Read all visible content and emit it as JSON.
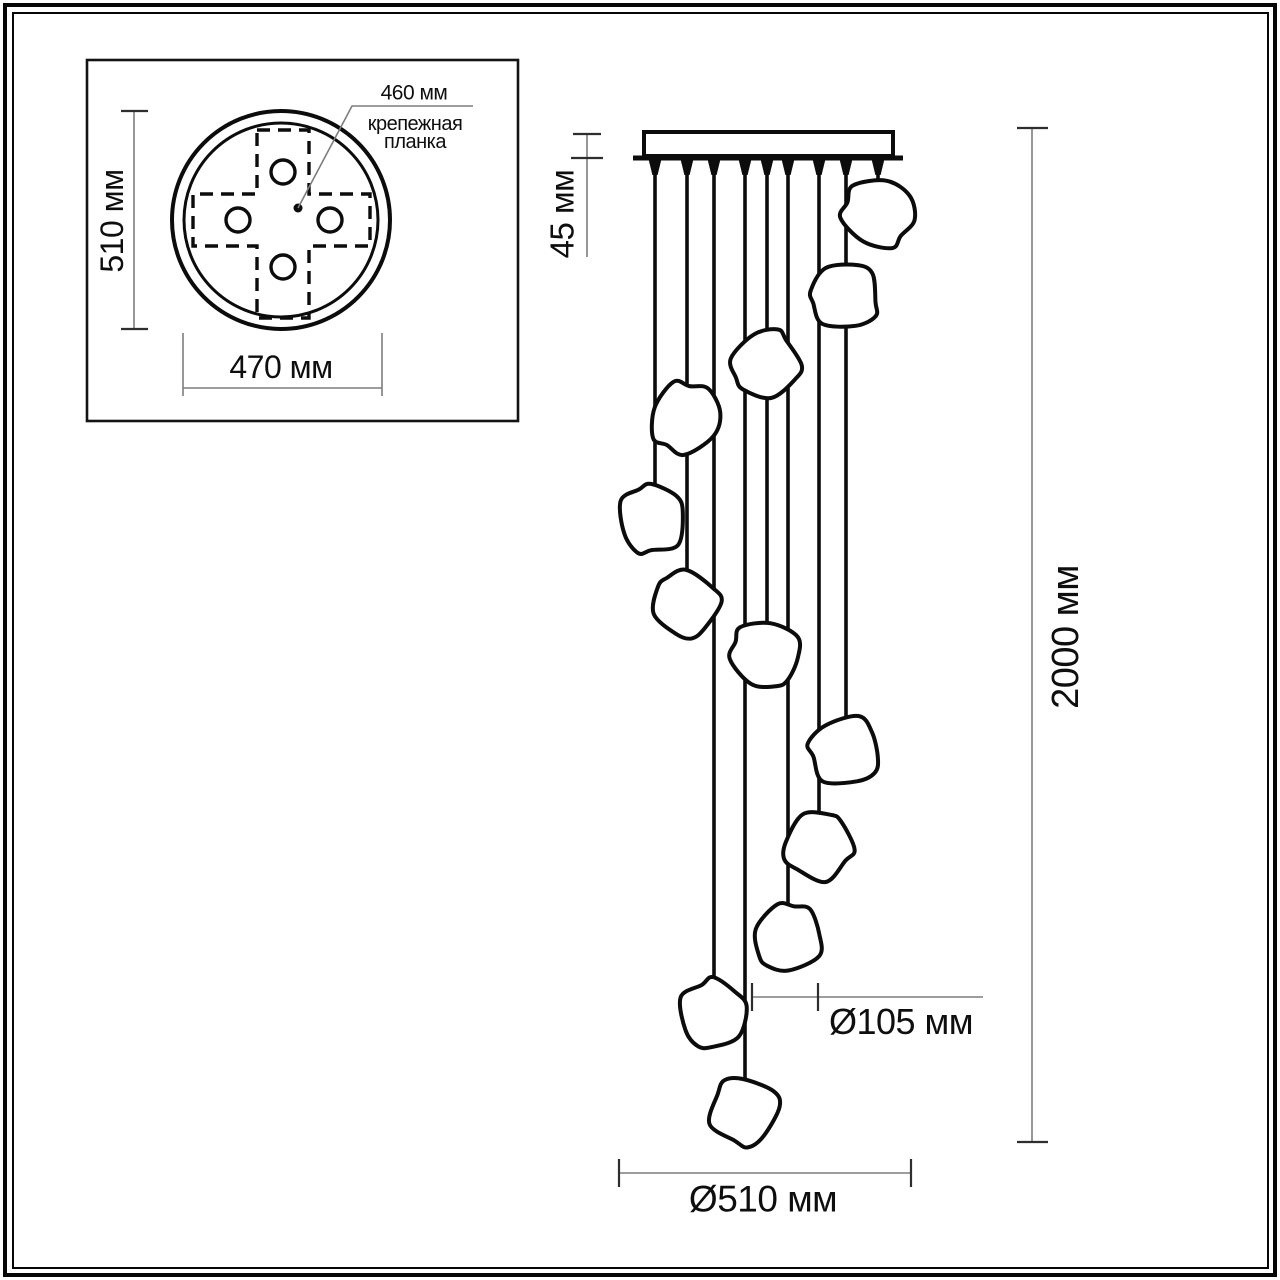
{
  "labels": {
    "mount_length": "460 мм",
    "mount_plate_line1": "крепежная",
    "mount_plate_line2": "планка",
    "canopy_height": "510 мм",
    "canopy_width": "470 мм",
    "plate_thickness": "45 мм",
    "total_height": "2000 мм",
    "shade_diameter": "Ø105 мм",
    "fixture_diameter": "Ø510 мм"
  },
  "dimensions_mm": {
    "mounting_bar_length": 460,
    "canopy_depth": 510,
    "canopy_width": 470,
    "ceiling_plate_thickness": 45,
    "total_suspension_height": 2000,
    "shade_diameter": 105,
    "fixture_footprint_diameter": 510,
    "shade_count": 12
  },
  "colors": {
    "background": "#ffffff",
    "drawing_line": "#0c0c0c",
    "dimension_line": "#7d7d7d",
    "tick_line": "#2e2e2e",
    "text": "#0e0e0e"
  },
  "diagram": {
    "presets": {
      "line4": {
        "stroke": "#0c0c0c",
        "stroke-width": "4",
        "fill": "none"
      },
      "line3": {
        "stroke": "#0c0c0c",
        "stroke-width": "3",
        "fill": "none"
      },
      "line5": {
        "stroke": "#0c0c0c",
        "stroke-width": "5",
        "fill": "none"
      },
      "lineThin": {
        "stroke": "#0c0c0c",
        "stroke-width": "3.6",
        "fill": "none"
      },
      "boxline": {
        "stroke": "#141414",
        "stroke-width": "2.6",
        "fill": "none"
      },
      "dash": {
        "stroke": "#0c0c0c",
        "stroke-width": "3.4",
        "fill": "none",
        "stroke-dasharray": "13 8"
      },
      "hole": {
        "stroke": "#0c0c0c",
        "stroke-width": "3.4",
        "fill": "#ffffff"
      },
      "solid": {
        "fill": "#0c0c0c",
        "stroke": "none"
      },
      "dim": {
        "stroke": "#7d7d7d",
        "stroke-width": "1.6",
        "fill": "none"
      },
      "tick": {
        "stroke": "#2e2e2e",
        "stroke-width": "2.2",
        "fill": "none"
      },
      "white4": {
        "fill": "#ffffff",
        "stroke": "#0c0c0c",
        "stroke-width": "4"
      }
    },
    "shapes": [
      {
        "type": "rect",
        "name": "top-view-inset-border",
        "preset": "boxline",
        "attrs": {
          "x": 87,
          "y": 60,
          "width": 431,
          "height": 361
        }
      },
      {
        "type": "circle",
        "name": "canopy-outer-circle",
        "preset": "line4",
        "attrs": {
          "cx": 281,
          "cy": 220,
          "r": 109
        }
      },
      {
        "type": "circle",
        "name": "canopy-inner-circle",
        "preset": "line3",
        "attrs": {
          "cx": 281,
          "cy": 220,
          "r": 97
        }
      },
      {
        "type": "path",
        "name": "mounting-bar-cross-dashed",
        "preset": "dash",
        "attrs": {
          "d": "M257,130 L309,130 L309,194 L370,194 L370,246 L309,246 L309,318 L257,318 L257,246 L193,246 L193,194 L257,194 Z"
        }
      },
      {
        "type": "circle",
        "name": "mount-hole-top",
        "preset": "hole",
        "attrs": {
          "cx": 283,
          "cy": 172,
          "r": 12
        }
      },
      {
        "type": "circle",
        "name": "mount-hole-left",
        "preset": "hole",
        "attrs": {
          "cx": 238,
          "cy": 220,
          "r": 12
        }
      },
      {
        "type": "circle",
        "name": "mount-hole-right",
        "preset": "hole",
        "attrs": {
          "cx": 330,
          "cy": 220,
          "r": 12
        }
      },
      {
        "type": "circle",
        "name": "mount-hole-bottom",
        "preset": "hole",
        "attrs": {
          "cx": 283,
          "cy": 267,
          "r": 12
        }
      },
      {
        "type": "circle",
        "name": "center-point-dot",
        "preset": "solid",
        "attrs": {
          "cx": 298,
          "cy": 208,
          "r": 4.5
        }
      },
      {
        "type": "polyline",
        "name": "leader-line-460mm",
        "preset": "dim",
        "attrs": {
          "points": "298,208 352,106 473,106"
        }
      },
      {
        "type": "line",
        "name": "dim-line-510mm-top-view",
        "preset": "dim",
        "attrs": {
          "x1": 134,
          "y1": 111,
          "x2": 134,
          "y2": 329
        }
      },
      {
        "type": "line",
        "name": "dim-tick",
        "preset": "tick",
        "attrs": {
          "x1": 121,
          "y1": 111,
          "x2": 148,
          "y2": 111
        }
      },
      {
        "type": "line",
        "name": "dim-tick",
        "preset": "tick",
        "attrs": {
          "x1": 121,
          "y1": 329,
          "x2": 148,
          "y2": 329
        }
      },
      {
        "type": "line",
        "name": "dim-ext-470-left",
        "preset": "dim",
        "attrs": {
          "x1": 183,
          "y1": 333,
          "x2": 183,
          "y2": 396
        }
      },
      {
        "type": "line",
        "name": "dim-ext-470-right",
        "preset": "dim",
        "attrs": {
          "x1": 382,
          "y1": 333,
          "x2": 382,
          "y2": 396
        }
      },
      {
        "type": "line",
        "name": "dim-line-470mm",
        "preset": "dim",
        "attrs": {
          "x1": 183,
          "y1": 388,
          "x2": 382,
          "y2": 388
        }
      },
      {
        "type": "line",
        "name": "dim-line-45mm",
        "preset": "dim",
        "attrs": {
          "x1": 587,
          "y1": 134,
          "x2": 587,
          "y2": 257
        }
      },
      {
        "type": "line",
        "name": "dim-tick",
        "preset": "tick",
        "attrs": {
          "x1": 573,
          "y1": 134,
          "x2": 601,
          "y2": 134
        }
      },
      {
        "type": "line",
        "name": "dim-tick",
        "preset": "tick",
        "attrs": {
          "x1": 571,
          "y1": 158,
          "x2": 603,
          "y2": 158
        }
      },
      {
        "type": "line",
        "name": "dim-line-2000mm",
        "preset": "dim",
        "attrs": {
          "x1": 1032,
          "y1": 128,
          "x2": 1032,
          "y2": 1142
        }
      },
      {
        "type": "line",
        "name": "dim-tick",
        "preset": "tick",
        "attrs": {
          "x1": 1017,
          "y1": 128,
          "x2": 1048,
          "y2": 128
        }
      },
      {
        "type": "line",
        "name": "dim-tick",
        "preset": "tick",
        "attrs": {
          "x1": 1017,
          "y1": 1142,
          "x2": 1048,
          "y2": 1142
        }
      },
      {
        "type": "line",
        "name": "dim-line-105mm",
        "preset": "dim",
        "attrs": {
          "x1": 752,
          "y1": 997,
          "x2": 983,
          "y2": 997
        }
      },
      {
        "type": "line",
        "name": "dim-tick",
        "preset": "tick",
        "attrs": {
          "x1": 752,
          "y1": 983,
          "x2": 752,
          "y2": 1011
        }
      },
      {
        "type": "line",
        "name": "dim-tick",
        "preset": "tick",
        "attrs": {
          "x1": 818,
          "y1": 983,
          "x2": 818,
          "y2": 1011
        }
      },
      {
        "type": "line",
        "name": "dim-line-510mm-bottom",
        "preset": "dim",
        "attrs": {
          "x1": 619,
          "y1": 1173,
          "x2": 911,
          "y2": 1173
        }
      },
      {
        "type": "line",
        "name": "dim-tick",
        "preset": "tick",
        "attrs": {
          "x1": 619,
          "y1": 1159,
          "x2": 619,
          "y2": 1187
        }
      },
      {
        "type": "line",
        "name": "dim-tick",
        "preset": "tick",
        "attrs": {
          "x1": 911,
          "y1": 1159,
          "x2": 911,
          "y2": 1187
        }
      },
      {
        "type": "line",
        "name": "ceiling-suspension-line",
        "preset": "line5",
        "attrs": {
          "x1": 633,
          "y1": 158,
          "x2": 903,
          "y2": 158
        }
      },
      {
        "type": "line",
        "name": "cord",
        "preset": "lineThin",
        "attrs": {
          "x1": 655,
          "y1": 158,
          "x2": 655,
          "y2": 487
        }
      },
      {
        "type": "line",
        "name": "cord",
        "preset": "lineThin",
        "attrs": {
          "x1": 687,
          "y1": 158,
          "x2": 687,
          "y2": 571
        }
      },
      {
        "type": "line",
        "name": "cord",
        "preset": "lineThin",
        "attrs": {
          "x1": 714,
          "y1": 158,
          "x2": 714,
          "y2": 981
        }
      },
      {
        "type": "line",
        "name": "cord",
        "preset": "lineThin",
        "attrs": {
          "x1": 745,
          "y1": 158,
          "x2": 745,
          "y2": 1078
        }
      },
      {
        "type": "line",
        "name": "cord",
        "preset": "lineThin",
        "attrs": {
          "x1": 767,
          "y1": 158,
          "x2": 767,
          "y2": 621
        }
      },
      {
        "type": "line",
        "name": "cord",
        "preset": "lineThin",
        "attrs": {
          "x1": 788,
          "y1": 158,
          "x2": 788,
          "y2": 905
        }
      },
      {
        "type": "line",
        "name": "cord",
        "preset": "lineThin",
        "attrs": {
          "x1": 819,
          "y1": 158,
          "x2": 819,
          "y2": 813
        }
      },
      {
        "type": "line",
        "name": "cord",
        "preset": "lineThin",
        "attrs": {
          "x1": 846,
          "y1": 158,
          "x2": 846,
          "y2": 718
        }
      },
      {
        "type": "line",
        "name": "cord",
        "preset": "lineThin",
        "attrs": {
          "x1": 878,
          "y1": 158,
          "x2": 878,
          "y2": 180
        }
      },
      {
        "type": "polygon",
        "name": "cord-grip",
        "preset": "solid",
        "attrs": {
          "points": "648.5,159 661.5,159 657.6,175 652.4,175"
        }
      },
      {
        "type": "polygon",
        "name": "cord-grip",
        "preset": "solid",
        "attrs": {
          "points": "680.5,159 693.5,159 689.6,175 684.4,175"
        }
      },
      {
        "type": "polygon",
        "name": "cord-grip",
        "preset": "solid",
        "attrs": {
          "points": "707.5,159 720.5,159 716.6,175 711.4,175"
        }
      },
      {
        "type": "polygon",
        "name": "cord-grip",
        "preset": "solid",
        "attrs": {
          "points": "738.5,159 751.5,159 747.6,175 742.4,175"
        }
      },
      {
        "type": "polygon",
        "name": "cord-grip",
        "preset": "solid",
        "attrs": {
          "points": "760.5,159 773.5,159 769.6,175 764.4,175"
        }
      },
      {
        "type": "polygon",
        "name": "cord-grip",
        "preset": "solid",
        "attrs": {
          "points": "781.5,159 794.5,159 790.6,175 785.4,175"
        }
      },
      {
        "type": "polygon",
        "name": "cord-grip",
        "preset": "solid",
        "attrs": {
          "points": "812.5,159 825.5,159 821.6,175 816.4,175"
        }
      },
      {
        "type": "polygon",
        "name": "cord-grip",
        "preset": "solid",
        "attrs": {
          "points": "839.5,159 852.5,159 848.6,175 843.4,175"
        }
      },
      {
        "type": "polygon",
        "name": "cord-grip",
        "preset": "solid",
        "attrs": {
          "points": "871.5,159 884.5,159 880.6,175 875.4,175"
        }
      },
      {
        "type": "rect",
        "name": "ceiling-plate",
        "preset": "white4",
        "attrs": {
          "x": 644,
          "y": 132,
          "width": 249,
          "height": 24
        }
      },
      {
        "type": "rock",
        "name": "shade",
        "preset": "white4",
        "cx": 878,
        "cy": 213,
        "r": 35,
        "seed": 1
      },
      {
        "type": "rock",
        "name": "shade",
        "preset": "white4",
        "cx": 845,
        "cy": 296,
        "r": 34,
        "seed": 2
      },
      {
        "type": "rock",
        "name": "shade",
        "preset": "white4",
        "cx": 766,
        "cy": 364,
        "r": 34,
        "seed": 3
      },
      {
        "type": "rock",
        "name": "shade",
        "preset": "white4",
        "cx": 685,
        "cy": 418,
        "r": 35,
        "seed": 4
      },
      {
        "type": "rock",
        "name": "shade",
        "preset": "white4",
        "cx": 652,
        "cy": 519,
        "r": 34,
        "seed": 5
      },
      {
        "type": "rock",
        "name": "shade",
        "preset": "white4",
        "cx": 686,
        "cy": 604,
        "r": 33,
        "seed": 6
      },
      {
        "type": "rock",
        "name": "shade",
        "preset": "white4",
        "cx": 765,
        "cy": 654,
        "r": 34,
        "seed": 7
      },
      {
        "type": "rock",
        "name": "shade",
        "preset": "white4",
        "cx": 845,
        "cy": 751,
        "r": 35,
        "seed": 8
      },
      {
        "type": "rock",
        "name": "shade",
        "preset": "white4",
        "cx": 818,
        "cy": 846,
        "r": 34,
        "seed": 9
      },
      {
        "type": "rock",
        "name": "shade",
        "preset": "white4",
        "cx": 788,
        "cy": 938,
        "r": 34,
        "seed": 10
      },
      {
        "type": "rock",
        "name": "shade",
        "preset": "white4",
        "cx": 713,
        "cy": 1014,
        "r": 34,
        "seed": 11
      },
      {
        "type": "rock",
        "name": "shade",
        "preset": "white4",
        "cx": 744,
        "cy": 1111,
        "r": 34,
        "seed": 12
      }
    ]
  }
}
